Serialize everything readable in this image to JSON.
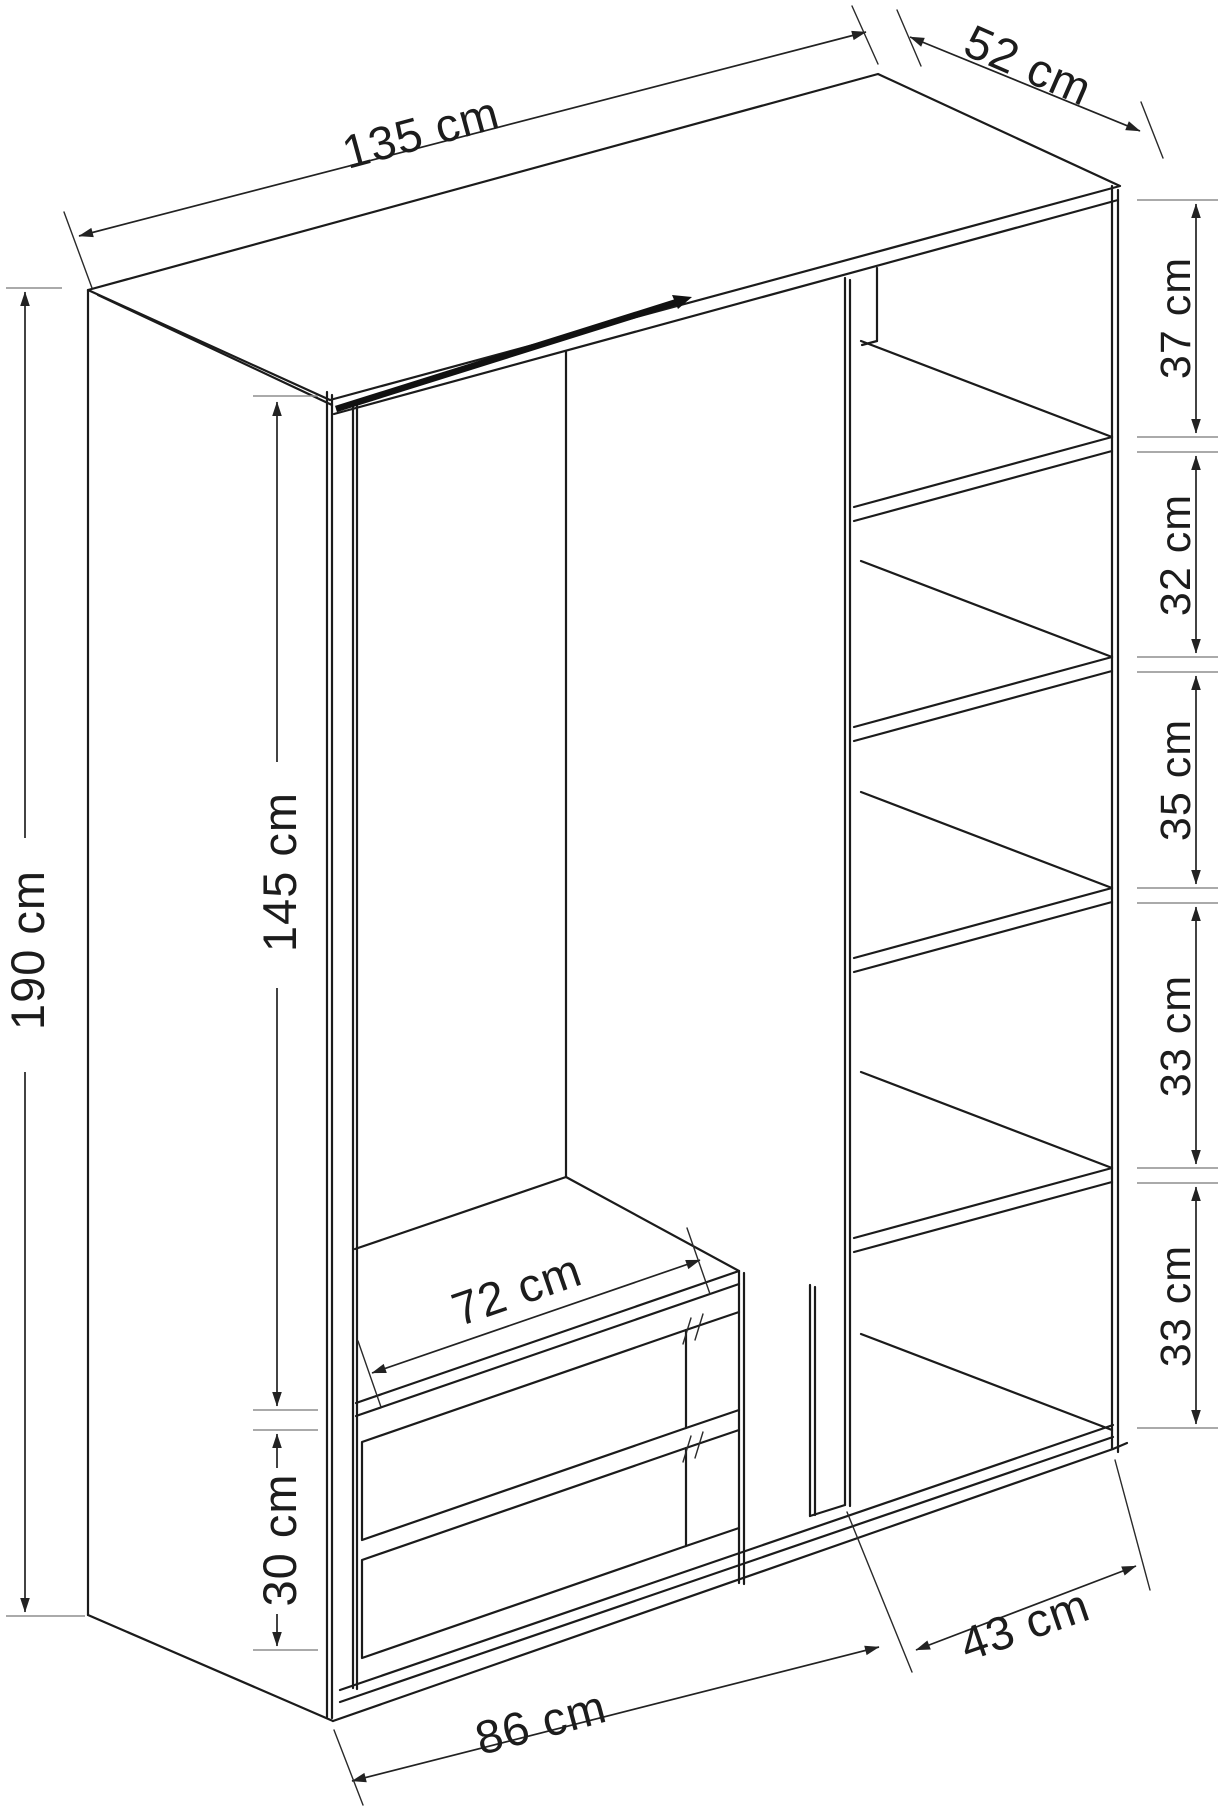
{
  "diagram": {
    "type": "furniture-dimension-drawing",
    "subject": "wardrobe",
    "unit": "cm",
    "dimensions": {
      "width": {
        "value": 135,
        "label": "135 cm"
      },
      "depth": {
        "value": 52,
        "label": "52 cm"
      },
      "height": {
        "value": 190,
        "label": "190 cm"
      },
      "hanging_height": {
        "value": 145,
        "label": "145 cm"
      },
      "drawer_height": {
        "value": 30,
        "label": "30 cm"
      },
      "hanging_width": {
        "value": 72,
        "label": "72 cm"
      },
      "left_width": {
        "value": 86,
        "label": "86 cm"
      },
      "shelf_width": {
        "value": 43,
        "label": "43 cm"
      },
      "shelf_gaps": [
        {
          "value": 37,
          "label": "37 cm"
        },
        {
          "value": 32,
          "label": "32 cm"
        },
        {
          "value": 35,
          "label": "35 cm"
        },
        {
          "value": 33,
          "label": "33 cm"
        },
        {
          "value": 33,
          "label": "33 cm"
        }
      ]
    },
    "colors": {
      "line": "#1b1b1b",
      "extension_line": "#8e8e8e",
      "background": "#ffffff"
    }
  }
}
